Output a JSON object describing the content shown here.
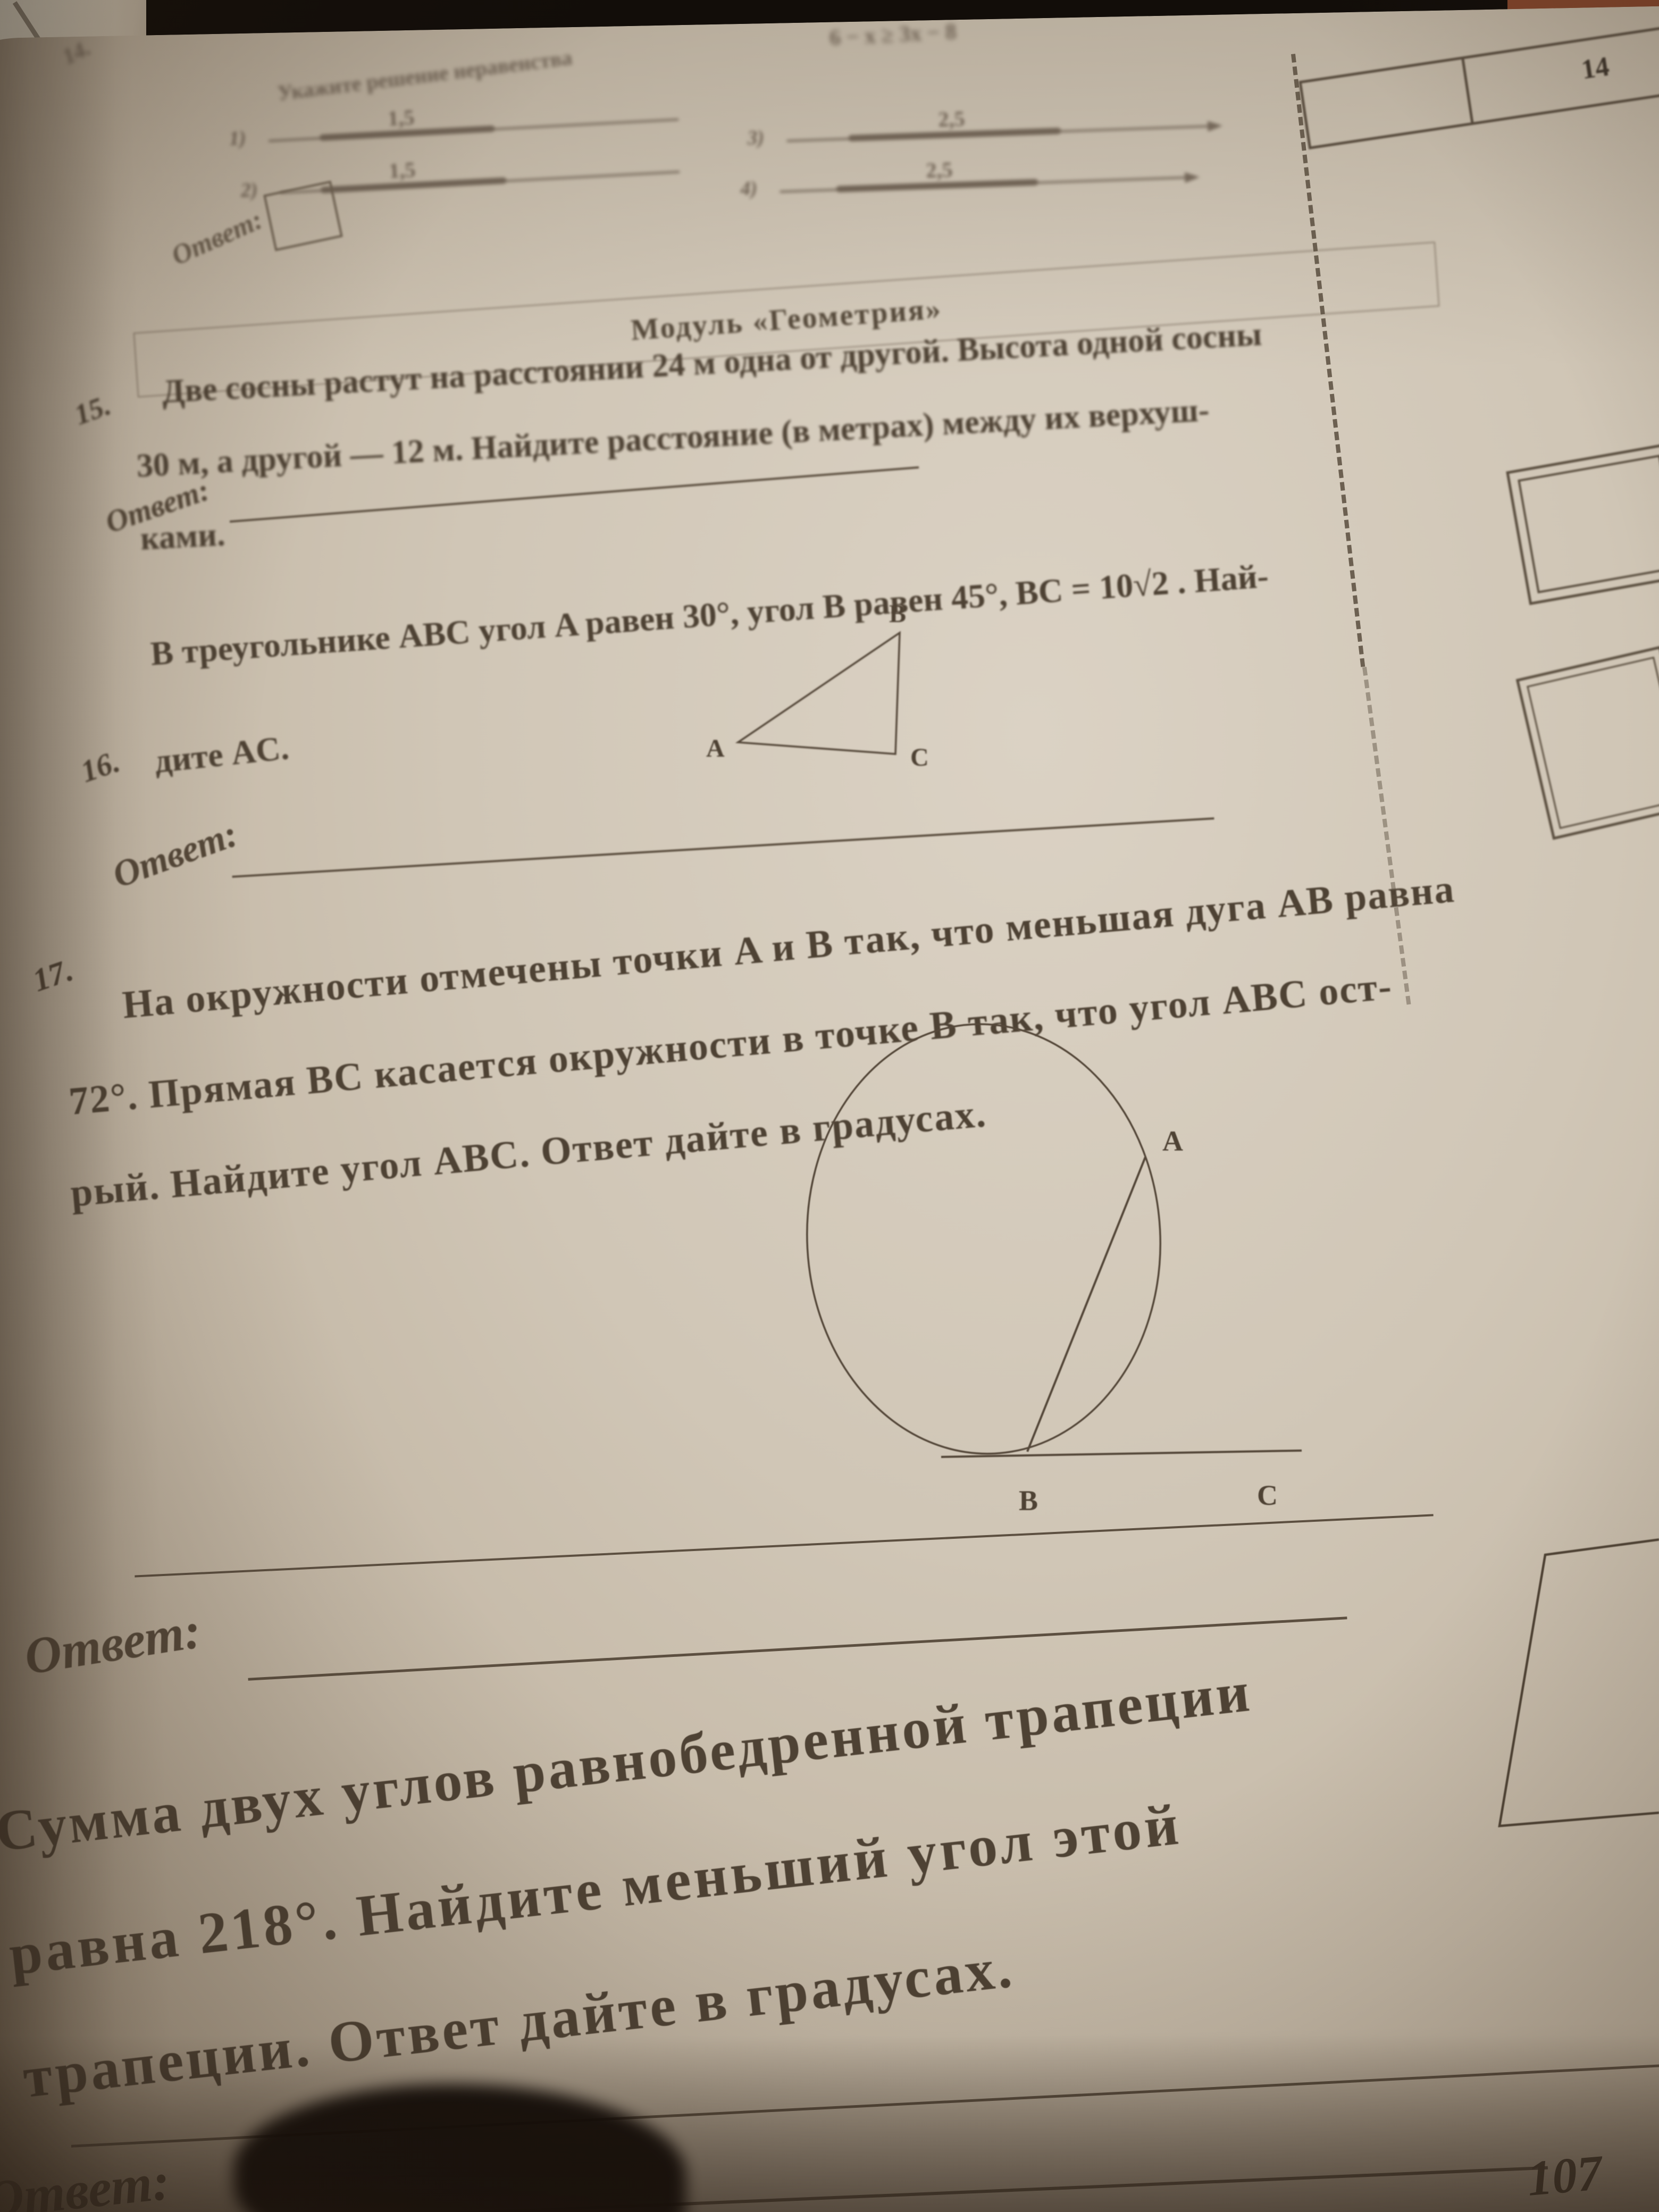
{
  "photo": {
    "module_header": "Модуль «Геометрия»",
    "corner_tab_number": "14",
    "page_number": "107"
  },
  "problem14_inequality": {
    "number": "14.",
    "heading": "Укажите решение неравенства",
    "equation": "6 − x ≥ 3x − 8",
    "options": [
      {
        "marker": "1)",
        "point_label": "1,5"
      },
      {
        "marker": "2)",
        "point_label": "1,5"
      },
      {
        "marker": "3)",
        "point_label": "2,5"
      },
      {
        "marker": "4)",
        "point_label": "2,5"
      }
    ],
    "answer_label": "Ответ:"
  },
  "problem15": {
    "number": "15.",
    "line1": "Две сосны растут на расстоянии 24 м одна от другой. Высота одной сосны",
    "line2": "30 м, а другой — 12 м. Найдите расстояние (в метрах) между их верхуш-",
    "line3": "ками.",
    "answer_label": "Ответ:"
  },
  "problem16": {
    "number": "16.",
    "line1": "В треугольнике ABC угол A равен 30°, угол B равен 45°, BC = 10√2 . Най-",
    "line2": "дите AC.",
    "labels": {
      "a": "A",
      "b": "B",
      "c": "C"
    },
    "answer_label": "Ответ:"
  },
  "problem17": {
    "number": "17.",
    "line1": "На окружности отмечены точки A и B так, что меньшая дуга AB равна",
    "line2": "72°. Прямая BC касается окружности в точке B так, что угол ABC ост-",
    "line3": "рый. Найдите угол ABC. Ответ дайте в градусах.",
    "labels": {
      "a": "A",
      "b": "B",
      "c": "C"
    },
    "answer_label": "Ответ:"
  },
  "problem18": {
    "line1": "Сумма двух углов равнобедренной трапеции",
    "line2": "равна 218°. Найдите меньший угол этой",
    "line3": "трапеции. Ответ дайте в градусах.",
    "answer_label": "Ответ:"
  }
}
